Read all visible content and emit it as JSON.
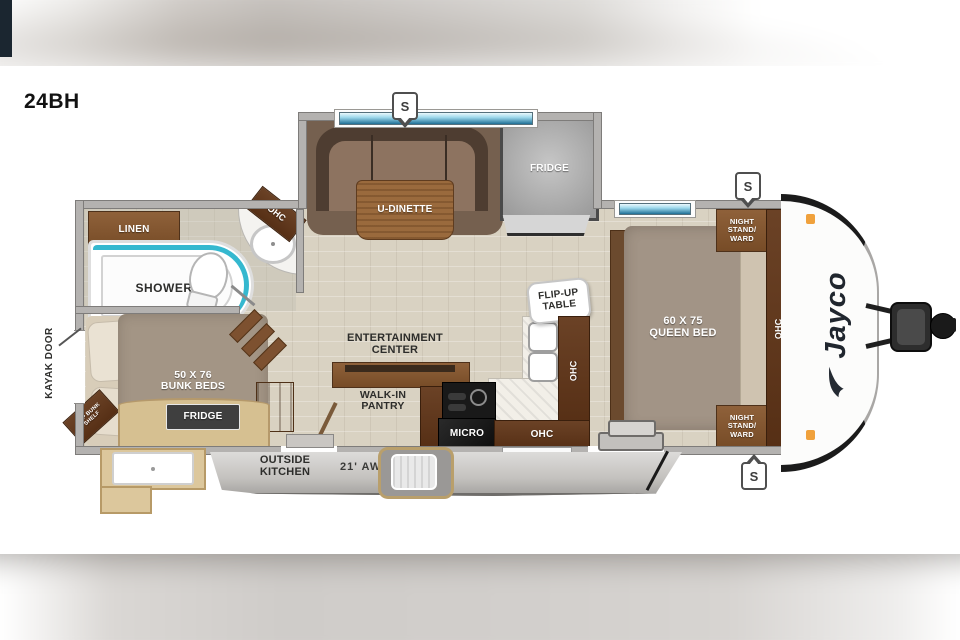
{
  "title": {
    "model": "24BH"
  },
  "markers": {
    "speaker": "S"
  },
  "colors": {
    "wall": "#b4b2b0",
    "floor": "#d9d2c2",
    "wood": "#8a5c36",
    "dark_wood": "#5d3a22",
    "shower_teal": "#35b8cf",
    "awning_gray": "#c6c4c1",
    "outside_tan": "#d6c091",
    "appliance_black": "#1a1a1a",
    "brand_navy": "#232a33",
    "clearance_orange": "#f0a13c",
    "window_blue": "#1f6f96"
  },
  "rooms": {
    "bath": {
      "linen": "LINEN",
      "shower": "SHOWER",
      "ohc": "OHC"
    },
    "bunk": {
      "bed": "50 X 76\nBUNK BEDS",
      "shelf": "TOP BUNK\nSHELF"
    },
    "living": {
      "dinette": "U-DINETTE",
      "fridge": "FRIDGE",
      "ent": "ENTERTAINMENT\nCENTER",
      "pantry": "WALK-IN\nPANTRY"
    },
    "kitchen": {
      "flip": "FLIP-UP\nTABLE",
      "ohc_side": "OHC",
      "ohc_lower": "OHC",
      "micro": "MICRO"
    },
    "bedroom": {
      "bed": "60 X 75\nQUEEN BED",
      "ns_front": "NIGHT\nSTAND/\nWARD",
      "ns_rear": "NIGHT\nSTAND/\nWARD",
      "ohc": "OHC"
    }
  },
  "exterior": {
    "kayak": "KAYAK DOOR",
    "awning": "21' AWNING",
    "outside_kitchen": "OUTSIDE\nKITCHEN",
    "outside_fridge": "FRIDGE",
    "brand": "Jayco"
  }
}
